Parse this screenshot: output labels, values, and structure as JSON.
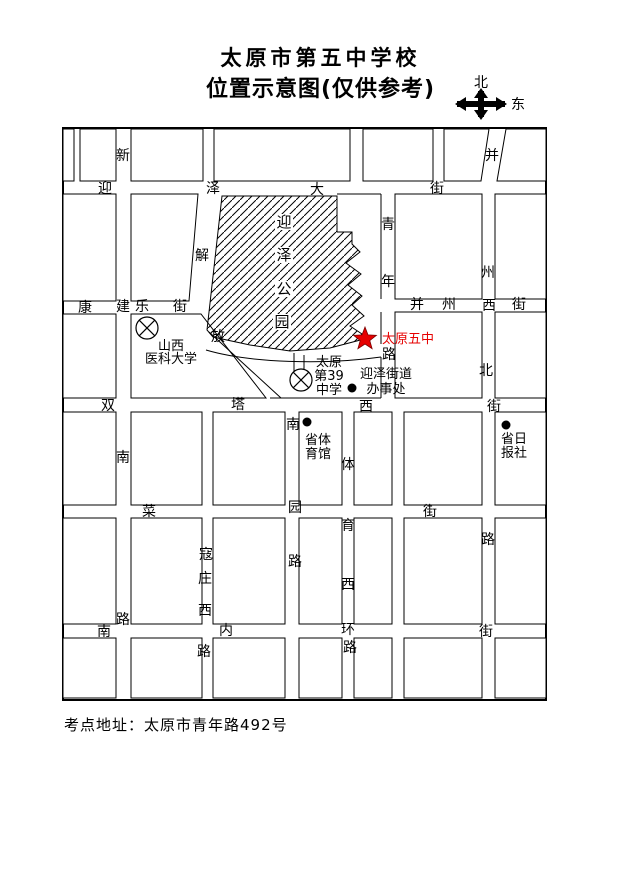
{
  "title": {
    "line1": "太原市第五中学校",
    "line2": "位置示意图(仅供参考)"
  },
  "compass": {
    "north_label": "北",
    "east_label": "东"
  },
  "footer": {
    "text": "考点地址：太原市青年路492号"
  },
  "map": {
    "frame": {
      "x": 63,
      "y": 128,
      "w": 483,
      "h": 572
    },
    "ink": "#000000",
    "accent_red": "#e60000",
    "blocks": [
      [
        63,
        129,
        11,
        52
      ],
      [
        80,
        129,
        36,
        52
      ],
      [
        131,
        129,
        72,
        52
      ],
      [
        214,
        129,
        136,
        52
      ],
      [
        363,
        129,
        70,
        52
      ],
      [
        63,
        194,
        53,
        107
      ],
      [
        395,
        194,
        87,
        105
      ],
      [
        495,
        194,
        51,
        105
      ],
      [
        63,
        314,
        53,
        84
      ],
      [
        395,
        312,
        87,
        86
      ],
      [
        495,
        312,
        51,
        86
      ],
      [
        63,
        412,
        53,
        93
      ],
      [
        131,
        412,
        71,
        93
      ],
      [
        213,
        412,
        72,
        93
      ],
      [
        299,
        412,
        43,
        93
      ],
      [
        354,
        412,
        38,
        93
      ],
      [
        404,
        412,
        78,
        93
      ],
      [
        495,
        412,
        51,
        93
      ],
      [
        63,
        518,
        53,
        106
      ],
      [
        131,
        518,
        71,
        106
      ],
      [
        213,
        518,
        72,
        106
      ],
      [
        299,
        518,
        43,
        106
      ],
      [
        354,
        518,
        38,
        106
      ],
      [
        404,
        518,
        78,
        106
      ],
      [
        495,
        518,
        51,
        106
      ],
      [
        63,
        638,
        53,
        60
      ],
      [
        131,
        638,
        71,
        60
      ],
      [
        213,
        638,
        72,
        60
      ],
      [
        299,
        638,
        43,
        60
      ],
      [
        354,
        638,
        38,
        60
      ],
      [
        404,
        638,
        78,
        60
      ],
      [
        495,
        638,
        51,
        60
      ]
    ],
    "block_polys": [
      "444,129 489,129 481,181 444,181",
      "506,129 546,129 546,181 497,181",
      "131,194 198,194 189,301 131,301",
      "131,314 201,314 266,398 131,398"
    ],
    "park": {
      "name": "迎泽公园",
      "points": "222,196 337,196 337,232 352,232 352,244 360,252 346,263 361,274 348,285 362,296 352,305 364,316 350,326 368,338 330,348 290,351 250,345 213,337 207,330",
      "labels": [
        [
          "迎",
          284,
          222
        ],
        [
          "泽",
          284,
          255
        ],
        [
          "公",
          284,
          289
        ],
        [
          "园",
          282,
          322
        ]
      ]
    },
    "lines": [
      [
        381,
        194,
        381,
        299
      ],
      [
        381,
        312,
        381,
        344
      ],
      [
        381,
        357,
        381,
        398
      ],
      [
        270,
        398,
        381,
        398
      ],
      [
        337,
        194,
        381,
        194
      ],
      [
        209,
        332,
        281,
        398
      ],
      [
        294,
        353,
        294,
        375
      ],
      [
        304,
        355,
        304,
        375
      ]
    ],
    "curves": [
      "M206,350 C250,363 325,365 381,357"
    ],
    "streets": [
      {
        "name": "迎泽大街",
        "labels": [
          [
            "迎",
            105,
            188
          ],
          [
            "泽",
            213,
            188
          ],
          [
            "大",
            317,
            189
          ],
          [
            "街",
            437,
            188
          ]
        ]
      },
      {
        "name": "新建南路",
        "labels": [
          [
            "新",
            123,
            155
          ],
          [
            "建",
            123,
            306
          ],
          [
            "南",
            123,
            457
          ],
          [
            "路",
            123,
            619
          ]
        ]
      },
      {
        "name": "康乐街",
        "labels": [
          [
            "康",
            85,
            307
          ],
          [
            "乐",
            142,
            306
          ],
          [
            "街",
            180,
            306
          ]
        ]
      },
      {
        "name": "解放路",
        "labels": [
          [
            "解",
            202,
            255
          ],
          [
            "放",
            218,
            336
          ]
        ]
      },
      {
        "name": "青年路",
        "labels": [
          [
            "青",
            388,
            224
          ],
          [
            "年",
            388,
            281
          ],
          [
            "路",
            389,
            354
          ]
        ]
      },
      {
        "name": "并州北路",
        "labels": [
          [
            "并",
            492,
            155
          ],
          [
            "州",
            488,
            272
          ],
          [
            "北",
            486,
            370
          ],
          [
            "路",
            488,
            539
          ]
        ]
      },
      {
        "name": "并州西街",
        "labels": [
          [
            "并",
            417,
            304
          ],
          [
            "州",
            449,
            304
          ],
          [
            "西",
            489,
            305
          ],
          [
            "街",
            519,
            304
          ]
        ]
      },
      {
        "name": "双塔西街",
        "labels": [
          [
            "双",
            108,
            405
          ],
          [
            "塔",
            238,
            404
          ],
          [
            "西",
            366,
            406
          ],
          [
            "街",
            494,
            406
          ]
        ]
      },
      {
        "name": "菜园街",
        "labels": [
          [
            "菜",
            149,
            511
          ],
          [
            "街",
            430,
            511
          ]
        ]
      },
      {
        "name": "南园路",
        "labels": [
          [
            "南",
            293,
            424
          ],
          [
            "园",
            295,
            507
          ],
          [
            "路",
            295,
            561
          ]
        ]
      },
      {
        "name": "体育西路",
        "labels": [
          [
            "体",
            348,
            464
          ],
          [
            "育",
            348,
            525
          ],
          [
            "西",
            348,
            584
          ],
          [
            "路",
            350,
            647
          ]
        ]
      },
      {
        "name": "寇庄西路",
        "labels": [
          [
            "寇",
            206,
            554
          ],
          [
            "庄",
            205,
            578
          ],
          [
            "西",
            205,
            610
          ],
          [
            "路",
            204,
            651
          ]
        ]
      },
      {
        "name": "南内环街",
        "labels": [
          [
            "南",
            104,
            631
          ],
          [
            "内",
            226,
            630
          ],
          [
            "环",
            348,
            629
          ],
          [
            "街",
            486,
            631
          ]
        ]
      }
    ],
    "pois": [
      {
        "name": "山西医科大学",
        "lines": [
          "山西",
          "医科大学"
        ],
        "x": 171,
        "y": 346,
        "lh": 13,
        "color": "#000000"
      },
      {
        "name": "太原第39中学",
        "lines": [
          "太原",
          "第39",
          "中学"
        ],
        "x": 329,
        "y": 362,
        "lh": 14,
        "color": "#000000"
      },
      {
        "name": "迎泽街道办事处",
        "lines": [
          "迎泽街道",
          "办事处"
        ],
        "x": 386,
        "y": 374,
        "lh": 15,
        "color": "#000000"
      },
      {
        "name": "省体育馆",
        "lines": [
          "省体",
          "育馆"
        ],
        "x": 318,
        "y": 440,
        "lh": 14,
        "color": "#000000"
      },
      {
        "name": "省日报社",
        "lines": [
          "省日",
          "报社"
        ],
        "x": 514,
        "y": 439,
        "lh": 14,
        "color": "#000000"
      },
      {
        "name": "太原五中",
        "lines": [
          "太原五中"
        ],
        "x": 408,
        "y": 339,
        "lh": 14,
        "color": "#e60000"
      }
    ],
    "symbols": {
      "star": {
        "x": 365,
        "y": 339,
        "r": 12,
        "color": "#e60000"
      },
      "circle_x": [
        [
          147,
          328
        ],
        [
          301,
          380
        ]
      ],
      "dots": [
        [
          352,
          388
        ],
        [
          307,
          422
        ],
        [
          506,
          425
        ]
      ]
    }
  }
}
